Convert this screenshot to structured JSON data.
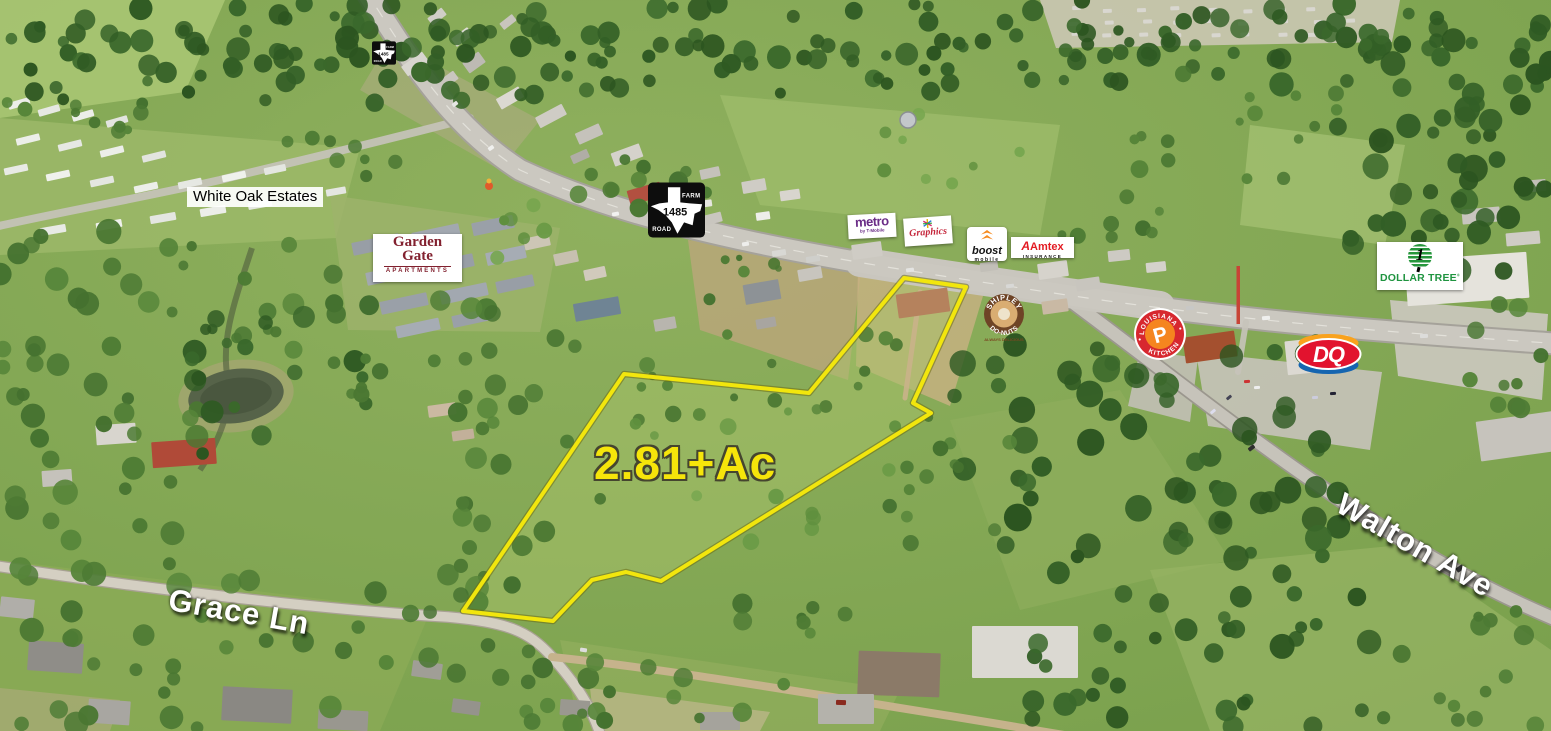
{
  "photo": {
    "acreage_label": "2.81+Ac"
  },
  "area_labels": {
    "white_oak_estates": "White Oak Estates"
  },
  "road_labels": {
    "grace_lane": "Grace Ln",
    "walton_ave": "Walton Ave"
  },
  "highway_sign": {
    "top": "FARM",
    "number": "1485",
    "bottom": "ROAD"
  },
  "signs": {
    "garden_gate": {
      "line1": "Garden",
      "line2": "Gate",
      "subtitle": "APARTMENTS"
    },
    "metro": {
      "name": "metro",
      "byline": "by T-Mobile"
    },
    "script_store": {
      "name": "Graphics"
    },
    "boost": {
      "name": "boost",
      "byline": "mobile"
    },
    "amtex": {
      "monogram": "A",
      "name": "Amtex",
      "subtitle": "INSURANCE"
    },
    "shipley": {
      "arc_top": "SHIPLEY",
      "arc_bottom": "DO-NUTS",
      "tagline": "ALWAYS DELICIOUS"
    },
    "popeyes": {
      "arc_top": "LOUISIANA",
      "arc_bottom": "KITCHEN",
      "monogram": "P"
    },
    "dq": {
      "monogram": "DQ"
    },
    "dollar_tree": {
      "numeral": "1",
      "name": "DOLLAR TREE",
      "registered": "®"
    }
  },
  "colors": {
    "parcel_outline": "#f2e60d",
    "acreage_text": "#f6e50a",
    "metro_purple": "#6b2d87",
    "boost_orange": "#f68b1f",
    "amtex_red": "#e31b23",
    "popeyes_red": "#d7282f",
    "popeyes_orange": "#f5851f",
    "dq_red": "#e2132e",
    "dq_orange": "#f9a21d",
    "dq_blue": "#1565b0",
    "dollar_tree_green": "#1f9440",
    "garden_gate_maroon": "#82212f",
    "shipley_brown": "#6e4426"
  }
}
